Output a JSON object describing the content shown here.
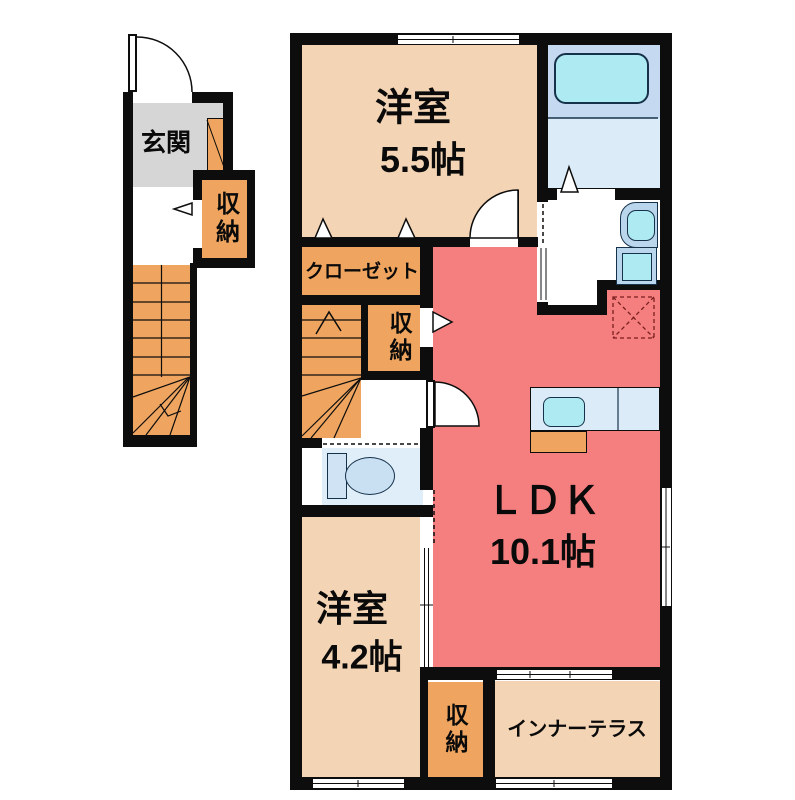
{
  "floorplan": {
    "rooms": {
      "western1": {
        "name": "洋室",
        "size": "5.5帖"
      },
      "ldk": {
        "name": "ＬＤＫ",
        "size": "10.1帖"
      },
      "western2": {
        "name": "洋室",
        "size": "4.2帖"
      },
      "entrance": {
        "label": "玄関"
      },
      "closet": {
        "label": "クローゼット"
      },
      "terrace": {
        "label": "インナーテラス"
      },
      "storage_entrance": {
        "label": "収納"
      },
      "storage_hall": {
        "label": "収納"
      },
      "storage_bedroom": {
        "label": "収納"
      }
    },
    "fixtures": [
      "bathtub",
      "toilet",
      "wash-basin",
      "washing-machine-pan",
      "kitchen-counter",
      "kitchen-sink",
      "stove",
      "refrigerator-space",
      "staircase"
    ]
  },
  "palette": {
    "wall": "#0d0d0d",
    "white": "#ffffff",
    "room-beige": "#f3d4b4",
    "ldk-salmon": "#f57f7f",
    "storage-orange": "#efa55f",
    "entrance-gray": "#d6d6d6",
    "bath-blue": "#c5daf0",
    "bath-floor-blue": "#dcebf8",
    "toilet-blue": "#e0eefa",
    "fixture-cyan": "#aeeaf2",
    "unit-blue": "#bad6ec"
  }
}
